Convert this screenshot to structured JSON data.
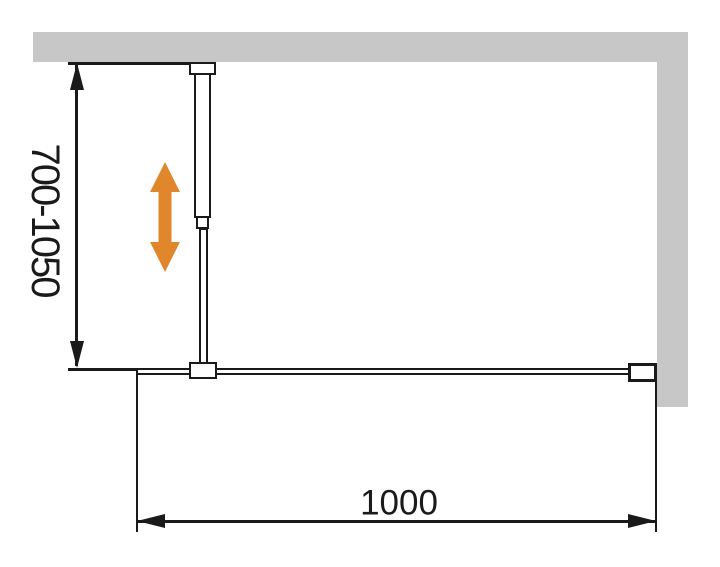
{
  "diagram": {
    "labels": {
      "height_range": "700-1050",
      "width": "1000"
    },
    "icons": {
      "adjust_arrow": "double-headed-vertical-arrow"
    },
    "colors": {
      "wall": "#C7C7C7",
      "line": "#1A1A1A",
      "adjust_arrow": "#E0862B",
      "background": "#FFFFFF"
    }
  }
}
